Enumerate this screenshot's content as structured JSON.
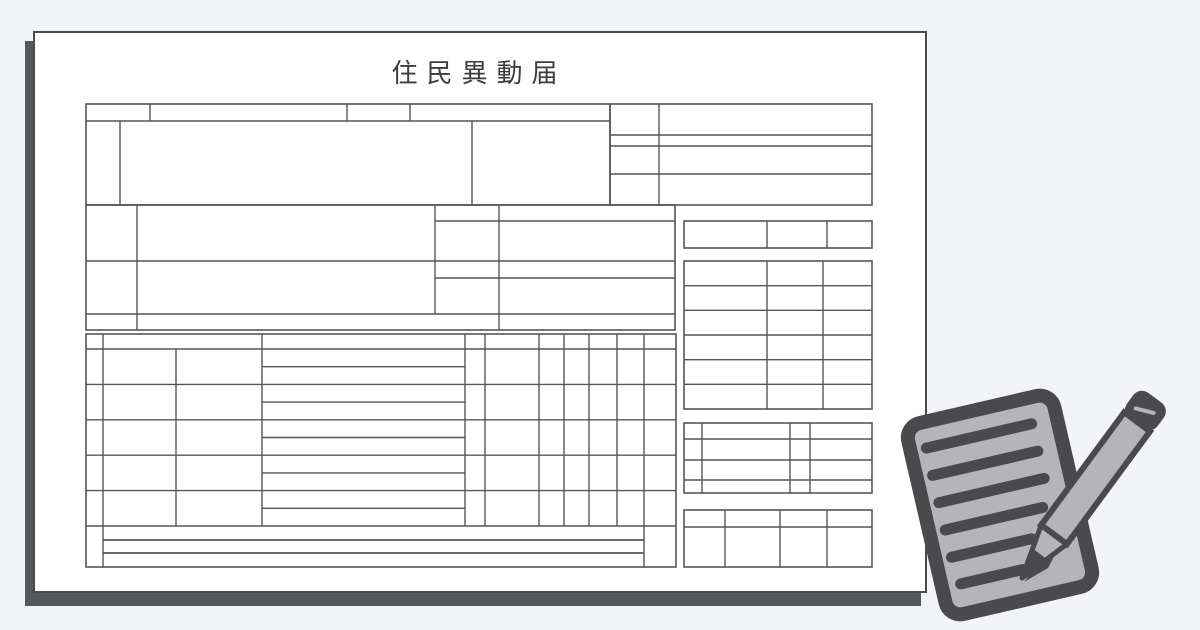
{
  "document": {
    "title": "住民異動届"
  },
  "icons": {
    "memo_pencil": "memo-pencil-icon"
  },
  "colors": {
    "background": "#f2f4f8",
    "paper": "#ffffff",
    "paper_border": "#4a4a4c",
    "shadow": "#56595b",
    "form_lines": "#555555",
    "title_text": "#3d3d3d",
    "icon_dark": "#4a4a4c",
    "icon_light": "#b5b5b7"
  }
}
